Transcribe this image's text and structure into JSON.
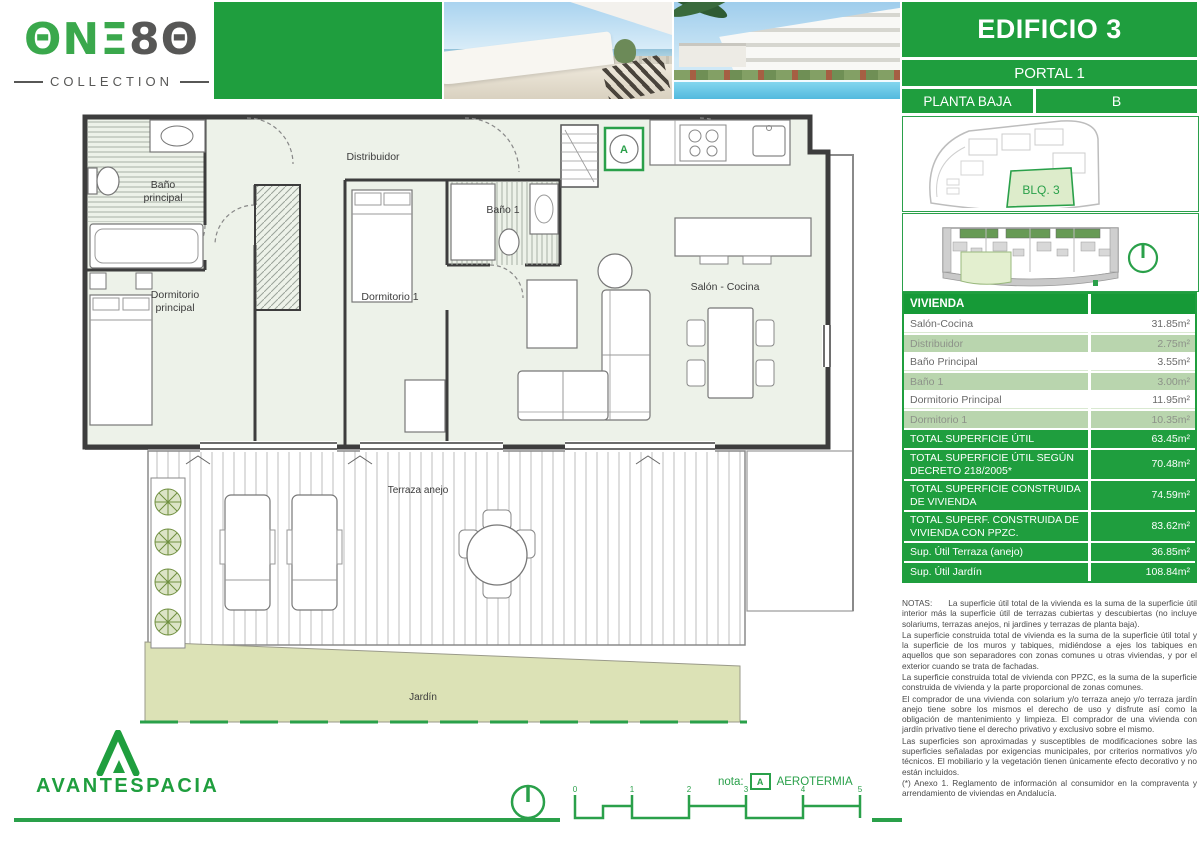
{
  "brand": {
    "logo_part1": "ΘN",
    "logo_part2": "Ξ",
    "logo_part3": "8Θ",
    "logo_sub": "COLLECTION",
    "developer": "AVANTESPACIA"
  },
  "header": {
    "building": "EDIFICIO 3",
    "portal": "PORTAL 1",
    "floor": "PLANTA BAJA",
    "unit": "B"
  },
  "siteplan": {
    "block_label": "BLQ. 3"
  },
  "floorplan": {
    "distribuidor": "Distribuidor",
    "bano_principal_l1": "Baño",
    "bano_principal_l2": "principal",
    "bano1": "Baño 1",
    "dormitorio_principal_l1": "Dormitorio",
    "dormitorio_principal_l2": "principal",
    "dormitorio1": "Dormitorio 1",
    "salon_cocina": "Salón - Cocina",
    "terraza": "Terraza anejo",
    "jardin": "Jardín",
    "marker_a": "A"
  },
  "table": {
    "title": "VIVIENDA",
    "rows": [
      {
        "label": "Salón-Cocina",
        "value": "31.85m²"
      },
      {
        "label": "Distribuidor",
        "value": "2.75m²"
      },
      {
        "label": "Baño Principal",
        "value": "3.55m²"
      },
      {
        "label": "Baño 1",
        "value": "3.00m²"
      },
      {
        "label": "Dormitorio Principal",
        "value": "11.95m²"
      },
      {
        "label": "Dormitorio 1",
        "value": "10.35m²"
      },
      {
        "label": "TOTAL SUPERFICIE ÚTIL",
        "value": "63.45m²"
      },
      {
        "label": "TOTAL SUPERFICIE ÚTIL SEGÚN DECRETO 218/2005*",
        "value": "70.48m²"
      },
      {
        "label": "TOTAL SUPERFICIE CONSTRUIDA DE VIVIENDA",
        "value": "74.59m²"
      },
      {
        "label": "TOTAL SUPERF. CONSTRUIDA DE VIVIENDA CON PPZC.",
        "value": "83.62m²"
      },
      {
        "label": "Sup. Útil Terraza (anejo)",
        "value": "36.85m²"
      },
      {
        "label": "Sup. Útil Jardín",
        "value": "108.84m²"
      }
    ]
  },
  "notes": {
    "label": "NOTAS:",
    "p1": "La superficie útil total de la vivienda es la suma de la superficie útil interior más la superficie útil de terrazas cubiertas y descubiertas (no incluye solariums, terrazas anejos, ni jardines y terrazas de planta baja).",
    "p2": "La superficie construida total de vivienda es la suma de la superficie útil total y la superficie de los muros y tabiques, midiéndose a ejes los tabiques en aquellos que son separadores con zonas comunes u otras viviendas, y por el exterior cuando se trata de fachadas.",
    "p3": "La superficie construida total de vivienda con PPZC, es la suma de la superficie construida de vivienda y la parte proporcional de zonas comunes.",
    "p4": "El comprador de una vivienda con solarium y/o terraza anejo y/o terraza jardín anejo tiene sobre los mismos el derecho de uso y disfrute así como la obligación de mantenimiento y limpieza. El comprador de una vivienda con jardín privativo tiene el derecho privativo y exclusivo sobre el mismo.",
    "p5": "Las superficies son aproximadas y susceptibles de modificaciones sobre las superficies señaladas por exigencias municipales, por criterios normativos y/o técnicos. El mobiliario y la vegetación tienen únicamente efecto decorativo y no están incluidos.",
    "p6": "(*) Anexo 1. Reglamento de información al consumidor en la compraventa y arrendamiento de viviendas en Andalucía."
  },
  "footer": {
    "nota_label": "nota:",
    "nota_marker": "A",
    "nota_text": "AEROTERMIA",
    "scale_ticks": [
      "0",
      "1",
      "2",
      "3",
      "4",
      "5"
    ]
  },
  "colors": {
    "green": "#1f9e3e",
    "green_dark": "#169a37",
    "tint_row": "#b9d5ae",
    "jardin_fill": "#dce2b6"
  }
}
